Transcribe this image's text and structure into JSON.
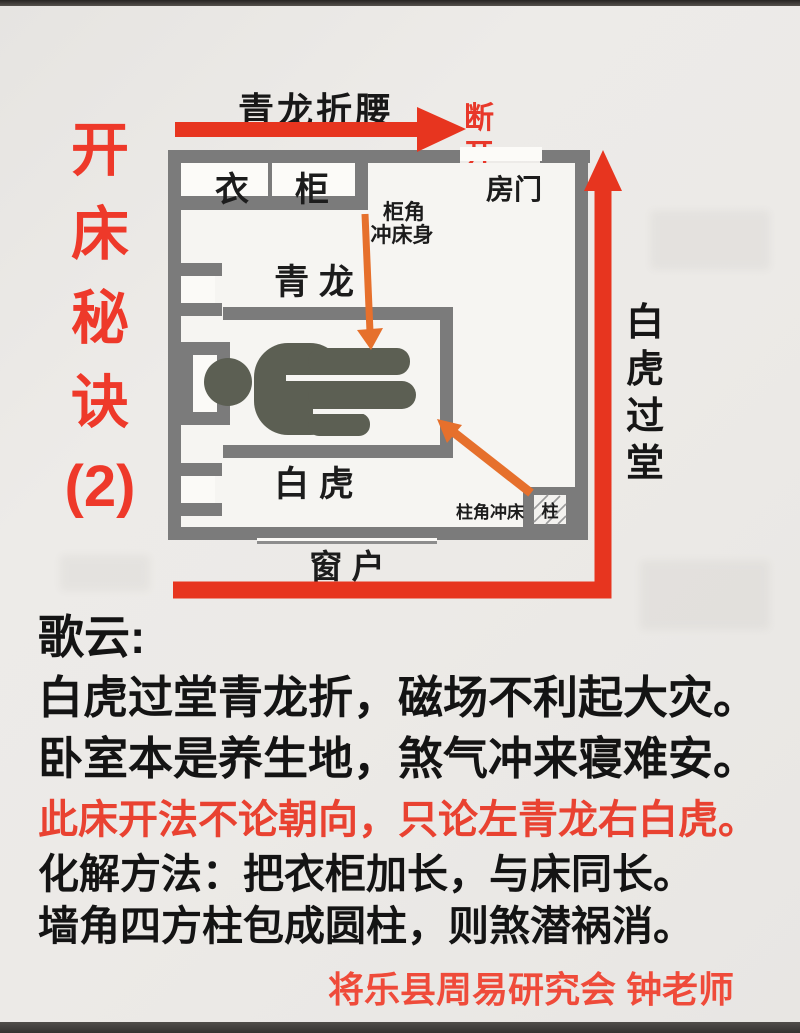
{
  "colors": {
    "accent_red": "#e8392a",
    "arrow_orange": "#e6702c",
    "wall_gray": "#7b7b7b",
    "person_olive": "#5c5f53",
    "text_black": "#161616",
    "page_bg": "#eae8e5"
  },
  "title": {
    "chars": [
      "开",
      "床",
      "秘",
      "诀",
      "(2)"
    ]
  },
  "diagram": {
    "top_arrow_label": "青龙折腰",
    "break_label": "断\n开",
    "right_label": {
      "chars": [
        "白",
        "虎",
        "过",
        "堂"
      ]
    },
    "room": {
      "wardrobe_char1": "衣",
      "wardrobe_char2": "柜",
      "door": "房门",
      "cabinet_corner_line1": "柜角",
      "cabinet_corner_line2": "冲床身",
      "green_dragon": "青  龙",
      "white_tiger": "白  虎",
      "pillar_corner": "柱角冲床",
      "pillar": "柱",
      "window": "窗  户"
    }
  },
  "verse": {
    "intro": "歌云:",
    "line1": "白虎过堂青龙折，磁场不利起大灾。",
    "line2": "卧室本是养生地，煞气冲来寝难安。",
    "line3": "此床开法不论朝向，只论左青龙右白虎。",
    "line4": "化解方法：把衣柜加长，与床同长。",
    "line5": "墙角四方柱包成圆柱，则煞潜祸消。",
    "signature": "将乐县周易研究会 钟老师"
  }
}
